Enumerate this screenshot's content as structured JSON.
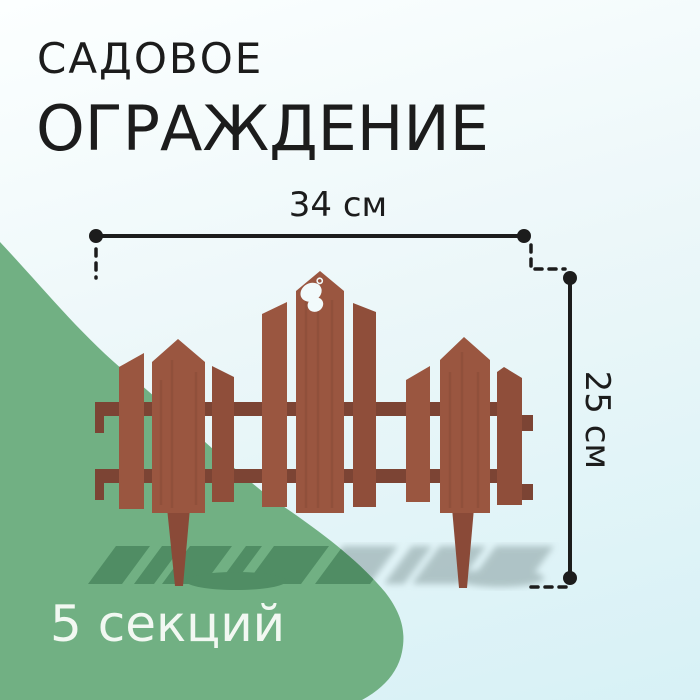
{
  "title": {
    "line1": "САДОВОЕ",
    "line2": "ОГРАЖДЕНИЕ"
  },
  "dimensions": {
    "width_label": "34 см",
    "height_label": "25 см"
  },
  "footer": {
    "sections_label": "5 секций"
  },
  "illustration": {
    "label": "garden-fence-with-picket-sections",
    "decor_icon": "butterfly-icon"
  },
  "theme": {
    "bg_top": "#fcffff",
    "bg_mid": "#ecf7f9",
    "bg_bottom": "#d7f1f6",
    "green_blob": "#71b083",
    "green_shadow": "#4d8a61",
    "gray_shadow": "#a3b8ba",
    "ink": "#1c1c1c",
    "text_light": "#f2f8f2",
    "fence_brown": "#9a5640",
    "fence_brown_alt": "#8f4e3a",
    "fence_rail": "#7c4434",
    "fence_stake": "#8a4a38",
    "cutout": "#f2fafb"
  }
}
